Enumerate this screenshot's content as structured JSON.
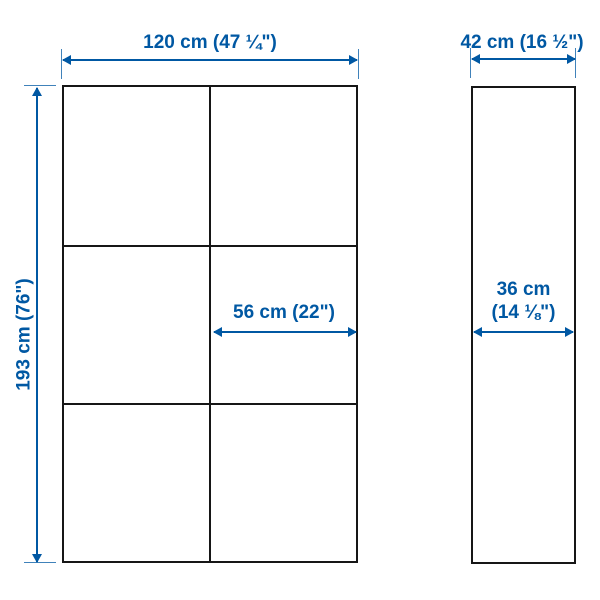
{
  "colors": {
    "accent_blue": "#0058a3",
    "outline_black": "#161616",
    "background": "#ffffff"
  },
  "front_view": {
    "grid_columns": 2,
    "grid_rows": 3,
    "width_label": "120 cm (47 ¼\")",
    "height_label": "193 cm (76\")",
    "inner_width_label": "56 cm (22\")"
  },
  "side_view": {
    "depth_label": "42 cm (16 ½\")",
    "inner_depth_label_line1": "36 cm",
    "inner_depth_label_line2": "(14 ⅛\")"
  }
}
